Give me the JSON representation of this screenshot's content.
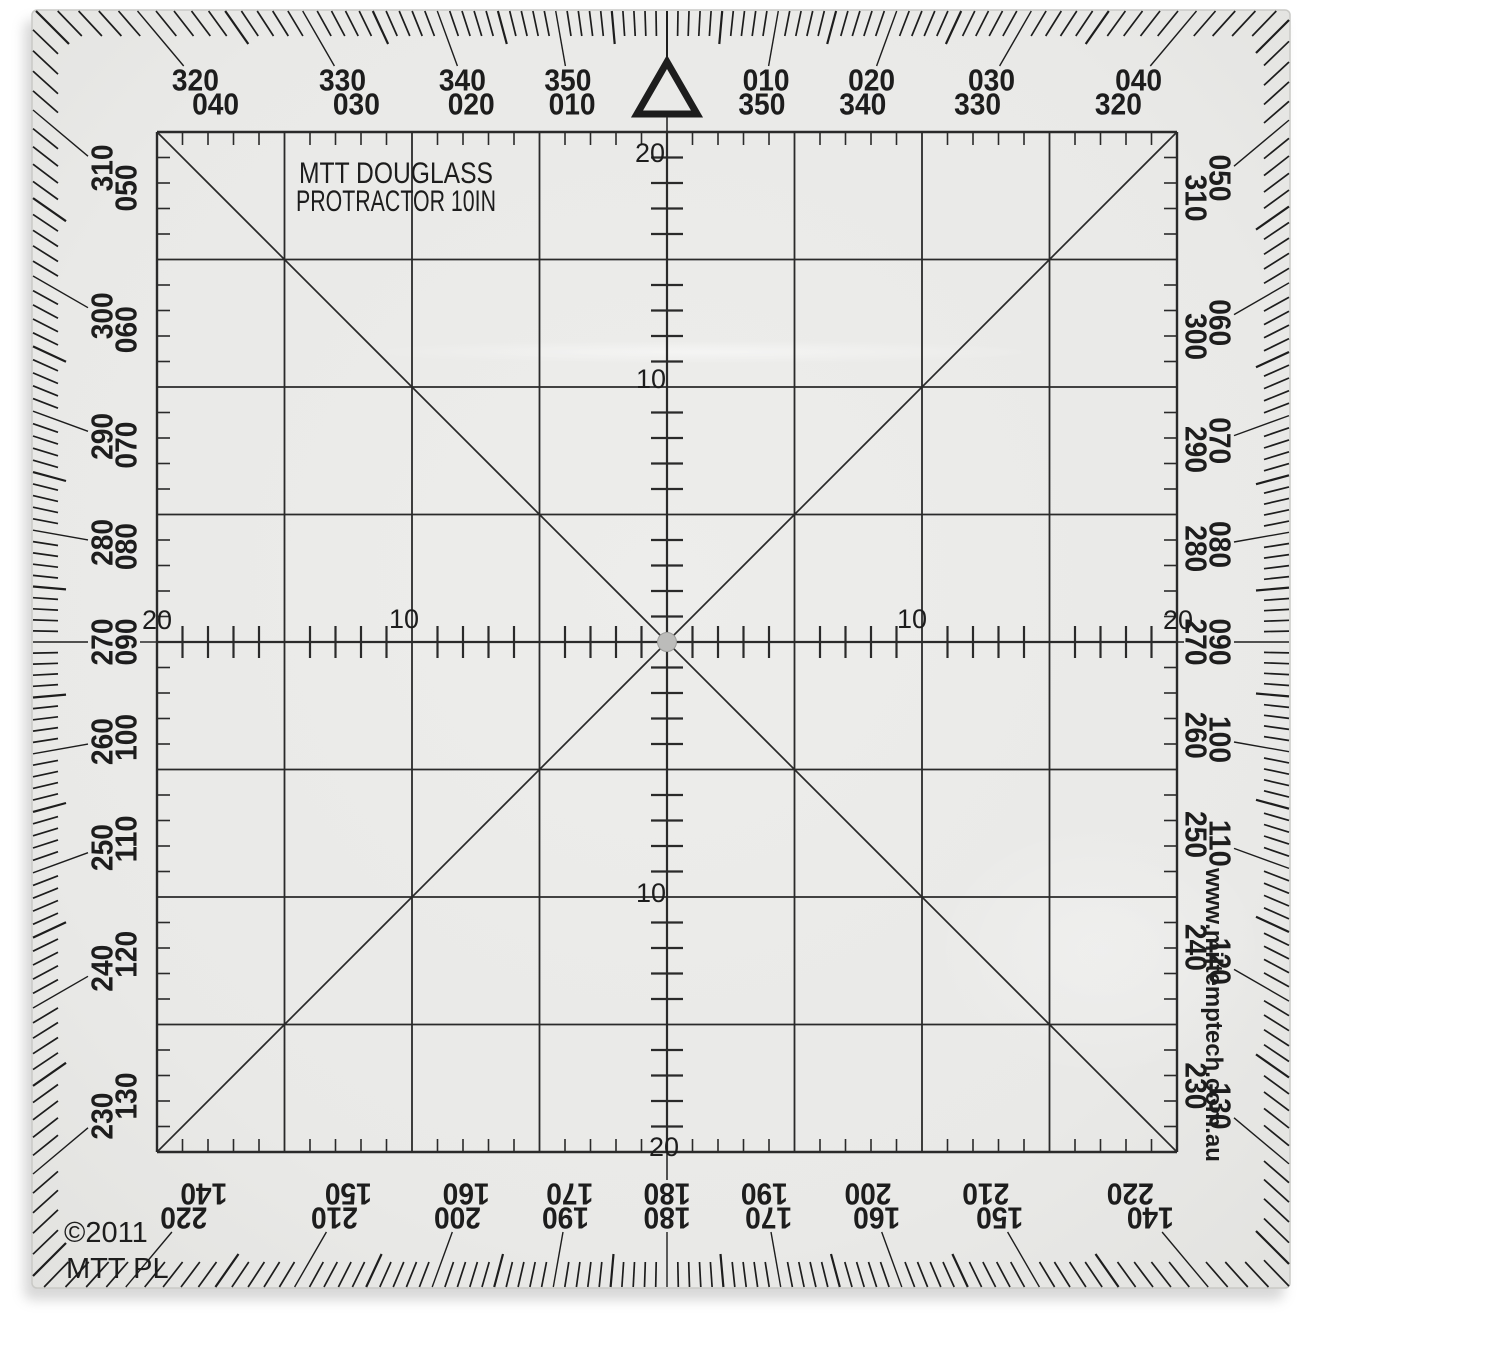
{
  "product": {
    "title_line1": "MTT DOUGLASS",
    "title_line2": "PROTRACTOR 10IN",
    "copyright_line1": "©2011",
    "copyright_line2": "MTT PL",
    "website": "www.miltemptech.com.au"
  },
  "compass_scale": {
    "north_index_marker": "open-triangle",
    "tick_interval_degrees": 1,
    "label_interval_degrees": 10,
    "top_labels": [
      {
        "outer": "320",
        "inner": "040"
      },
      {
        "outer": "330",
        "inner": "030"
      },
      {
        "outer": "340",
        "inner": "020"
      },
      {
        "outer": "350",
        "inner": "010"
      },
      {
        "outer": "010",
        "inner": "350"
      },
      {
        "outer": "020",
        "inner": "340"
      },
      {
        "outer": "030",
        "inner": "330"
      },
      {
        "outer": "040",
        "inner": "320"
      }
    ],
    "right_labels": [
      {
        "outer": "050",
        "inner": "310"
      },
      {
        "outer": "060",
        "inner": "300"
      },
      {
        "outer": "070",
        "inner": "290"
      },
      {
        "outer": "080",
        "inner": "280"
      },
      {
        "outer": "090",
        "inner": "270"
      },
      {
        "outer": "100",
        "inner": "260"
      },
      {
        "outer": "110",
        "inner": "250"
      },
      {
        "outer": "120",
        "inner": "240"
      },
      {
        "outer": "130",
        "inner": "230"
      }
    ],
    "bottom_labels": [
      {
        "outer": "220",
        "inner": "140"
      },
      {
        "outer": "210",
        "inner": "150"
      },
      {
        "outer": "200",
        "inner": "160"
      },
      {
        "outer": "190",
        "inner": "170"
      },
      {
        "outer": "180",
        "inner": "180"
      },
      {
        "outer": "170",
        "inner": "190"
      },
      {
        "outer": "160",
        "inner": "200"
      },
      {
        "outer": "150",
        "inner": "210"
      },
      {
        "outer": "140",
        "inner": "220"
      }
    ],
    "left_labels": [
      {
        "outer": "310",
        "inner": "050"
      },
      {
        "outer": "300",
        "inner": "060"
      },
      {
        "outer": "290",
        "inner": "070"
      },
      {
        "outer": "280",
        "inner": "080"
      },
      {
        "outer": "270",
        "inner": "090"
      },
      {
        "outer": "260",
        "inner": "100"
      },
      {
        "outer": "250",
        "inner": "110"
      },
      {
        "outer": "240",
        "inner": "120"
      },
      {
        "outer": "230",
        "inner": "130"
      }
    ]
  },
  "grid_rulers": {
    "horizontal_labels": [
      {
        "value": "20",
        "units_from_center": -20
      },
      {
        "value": "10",
        "units_from_center": -10
      },
      {
        "value": "10",
        "units_from_center": 10
      },
      {
        "value": "20",
        "units_from_center": 20
      }
    ],
    "vertical_labels": [
      {
        "value": "20",
        "units_from_center": -20
      },
      {
        "value": "10",
        "units_from_center": -10
      },
      {
        "value": "10",
        "units_from_center": 10
      },
      {
        "value": "20",
        "units_from_center": 20
      }
    ]
  },
  "colors": {
    "ink": "#1d1d1d",
    "grid_ink": "#2a2a2a",
    "plastic": "#e9e9e7",
    "plastic_edge": "#c9c9c6",
    "background": "#ffffff",
    "center_hole": "#bcbcba",
    "shadow": "#a8a8a8"
  }
}
